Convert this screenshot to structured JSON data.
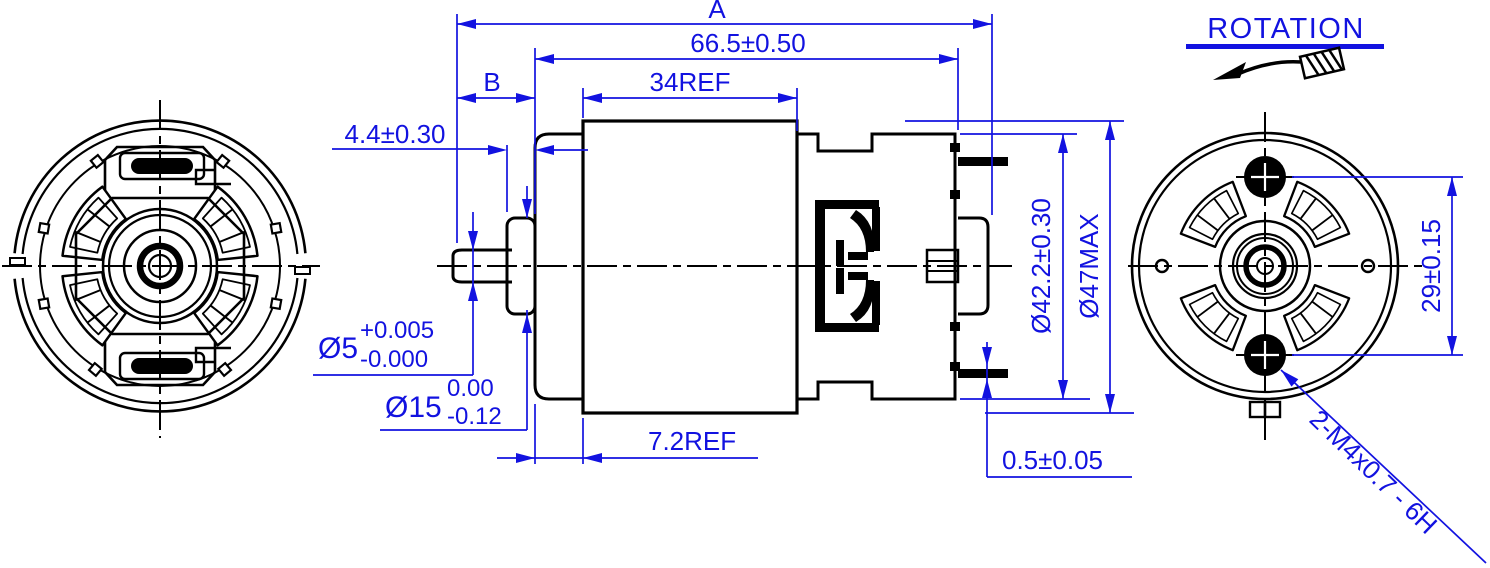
{
  "drawing_type": "motor-outline-3-view",
  "accent_color": "#1212e0",
  "line_color": "#000000",
  "labels": {
    "overall_length": "A",
    "body_length": "66.5±0.50",
    "shaft_extension": "B",
    "can_length": "34REF",
    "boss_length": "4.4±0.30",
    "shaft_dia": "Ø5",
    "shaft_dia_tol_upper": "+0.005",
    "shaft_dia_tol_lower": "-0.000",
    "boss_dia": "Ø15",
    "boss_dia_tol_upper": "0.00",
    "boss_dia_tol_lower": "-0.12",
    "flange_length": "7.2REF",
    "terminal_thickness": "0.5±0.05",
    "endcap_dia": "Ø42.2±0.30",
    "body_dia": "Ø47MAX",
    "mount_hole_spacing": "29±0.15",
    "mount_holes_spec": "2-M4x0.7 - 6H",
    "rotation": "ROTATION"
  }
}
